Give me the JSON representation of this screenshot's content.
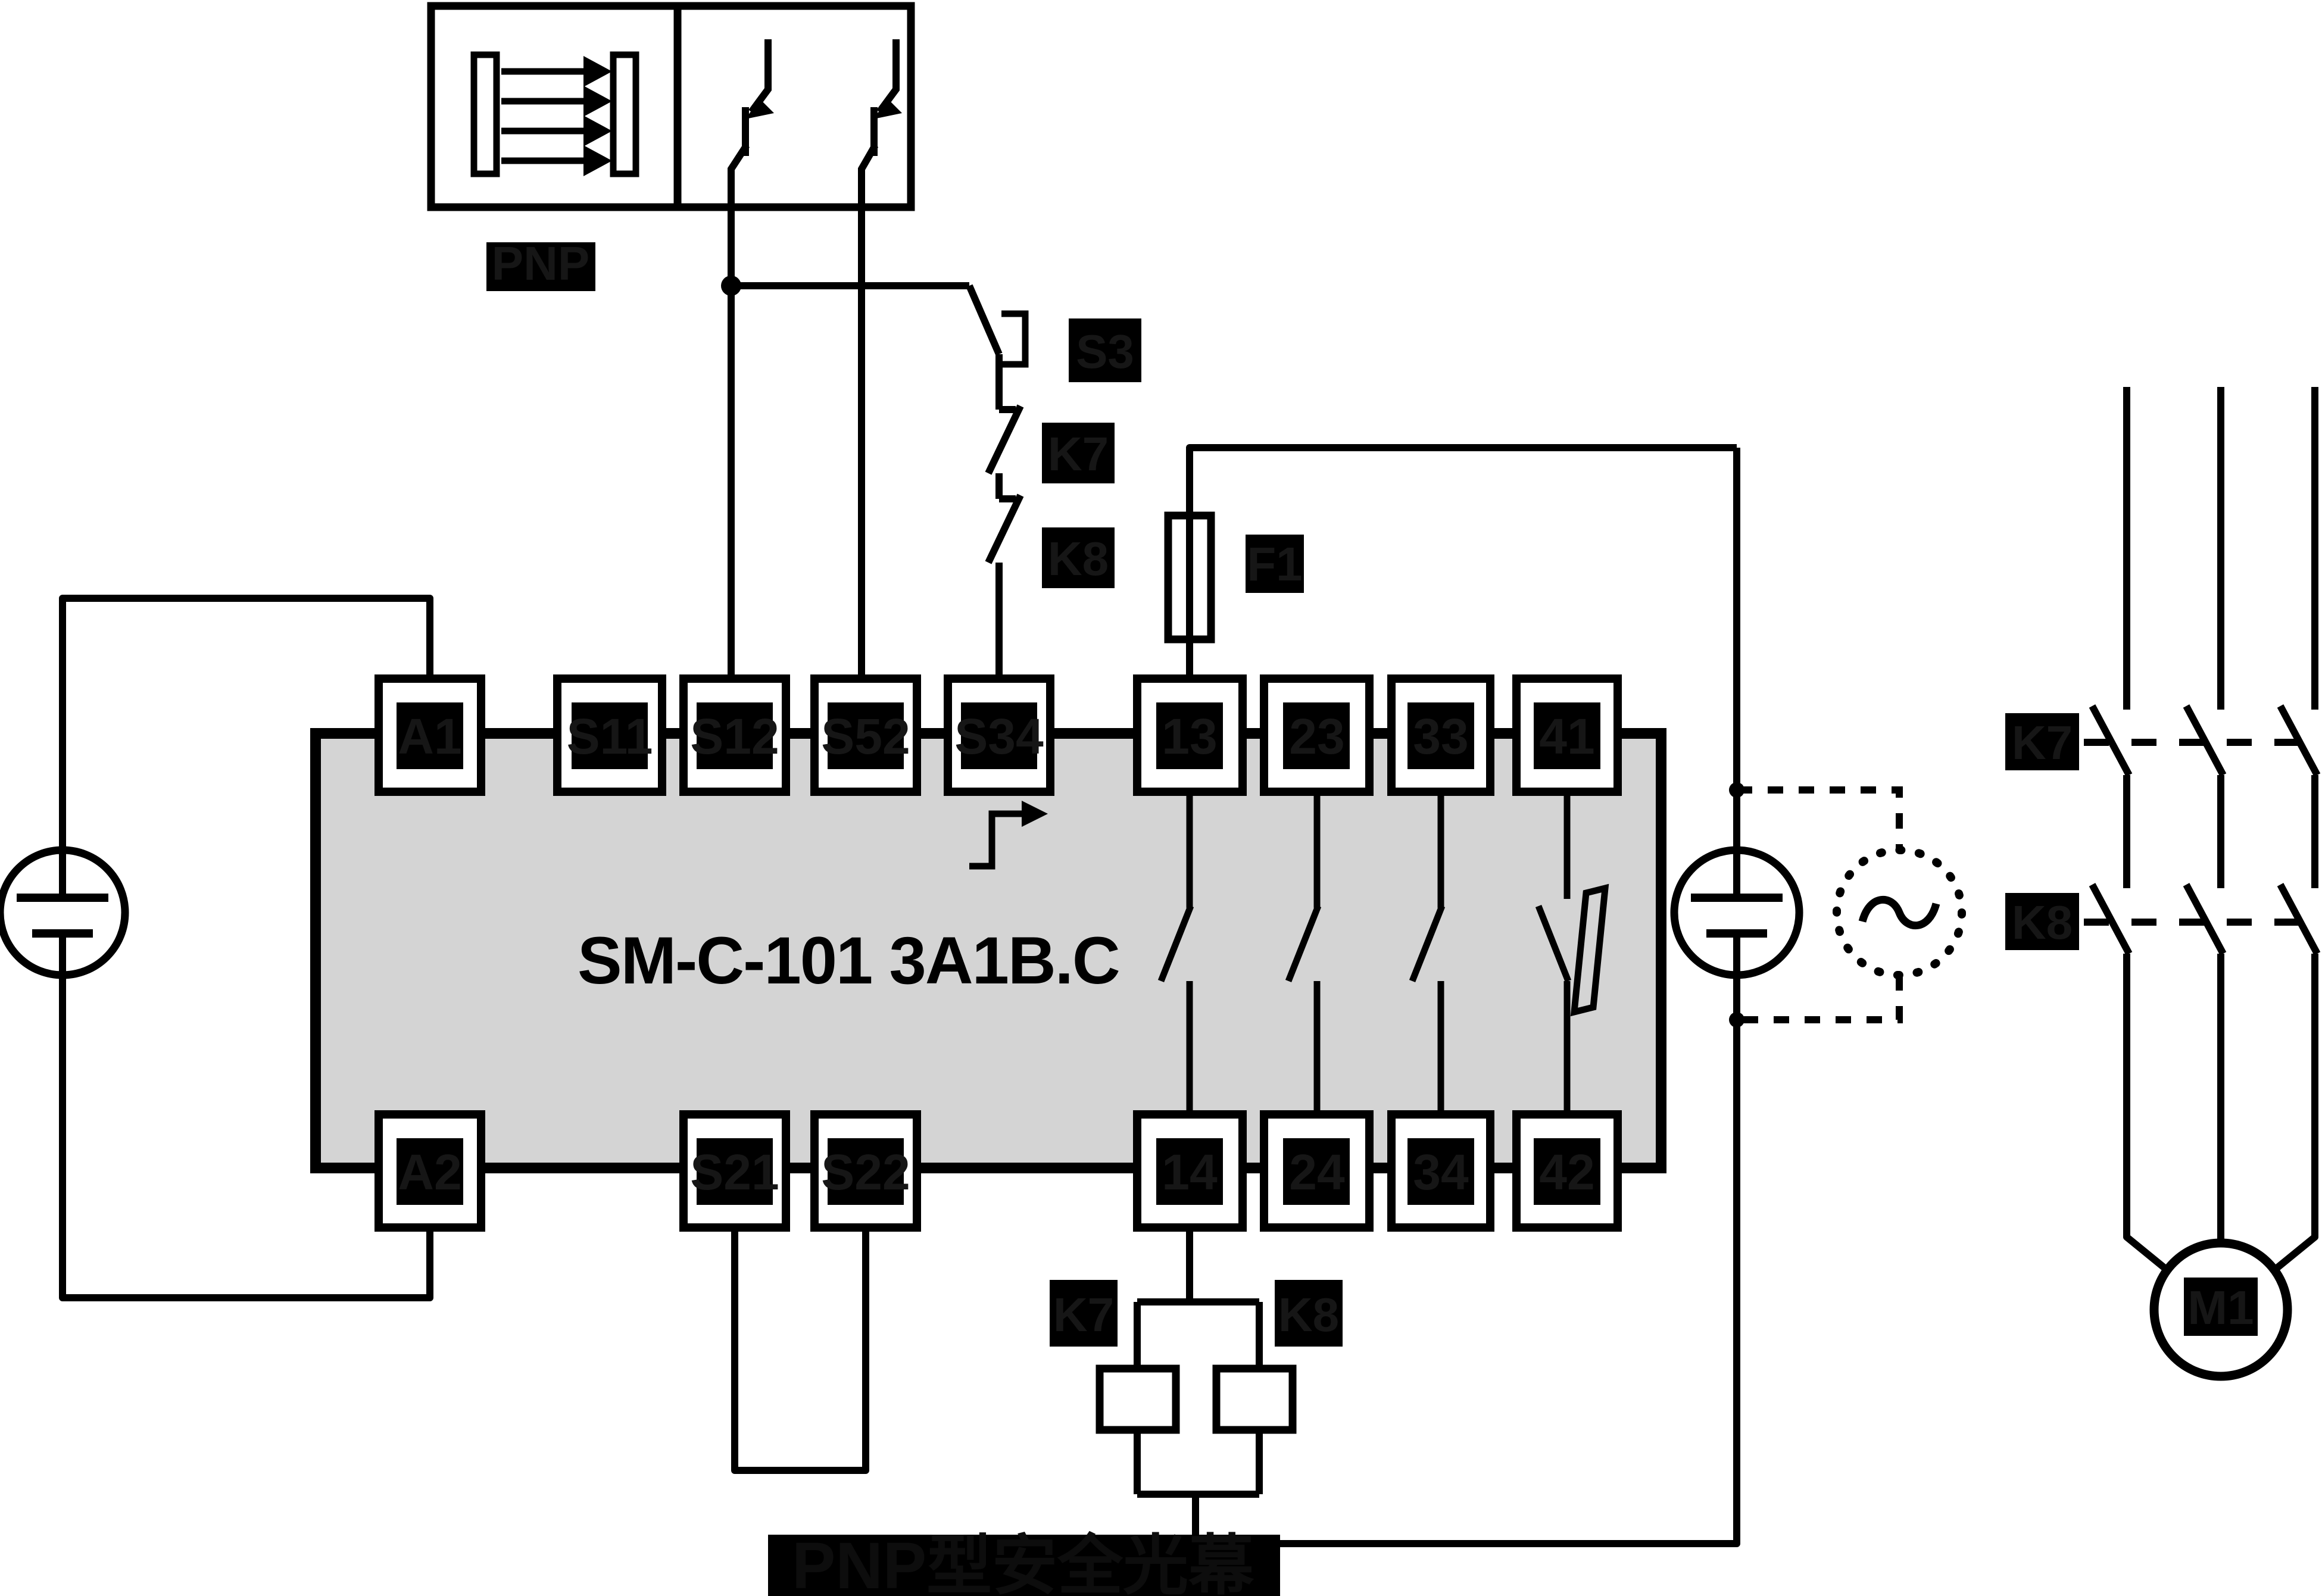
{
  "caption": "PNP型安全光幕",
  "sensor": {
    "type_label": "PNP"
  },
  "module": {
    "model": "SM-C-101 3A1B.C",
    "terminals_top": [
      {
        "label": "A1"
      },
      {
        "label": "S11"
      },
      {
        "label": "S12"
      },
      {
        "label": "S52"
      },
      {
        "label": "S34"
      },
      {
        "label": "13"
      },
      {
        "label": "23"
      },
      {
        "label": "33"
      },
      {
        "label": "41"
      }
    ],
    "terminals_bottom": [
      {
        "label": "A2"
      },
      {
        "label": "S21"
      },
      {
        "label": "S22"
      },
      {
        "label": "14"
      },
      {
        "label": "24"
      },
      {
        "label": "34"
      },
      {
        "label": "42"
      }
    ]
  },
  "control": {
    "reset_button": "S3",
    "feedback_contact_1": "K7",
    "feedback_contact_2": "K8",
    "fuse": "F1"
  },
  "coils": {
    "coil_1": "K7",
    "coil_2": "K8"
  },
  "power_circuit": {
    "contactor_1": "K7",
    "contactor_2": "K8",
    "motor": "M1"
  },
  "colors": {
    "line": "#000000",
    "module_fill": "#d4d4d4",
    "label_bg": "#000000",
    "label_text": "#161616",
    "background": "#ffffff"
  }
}
